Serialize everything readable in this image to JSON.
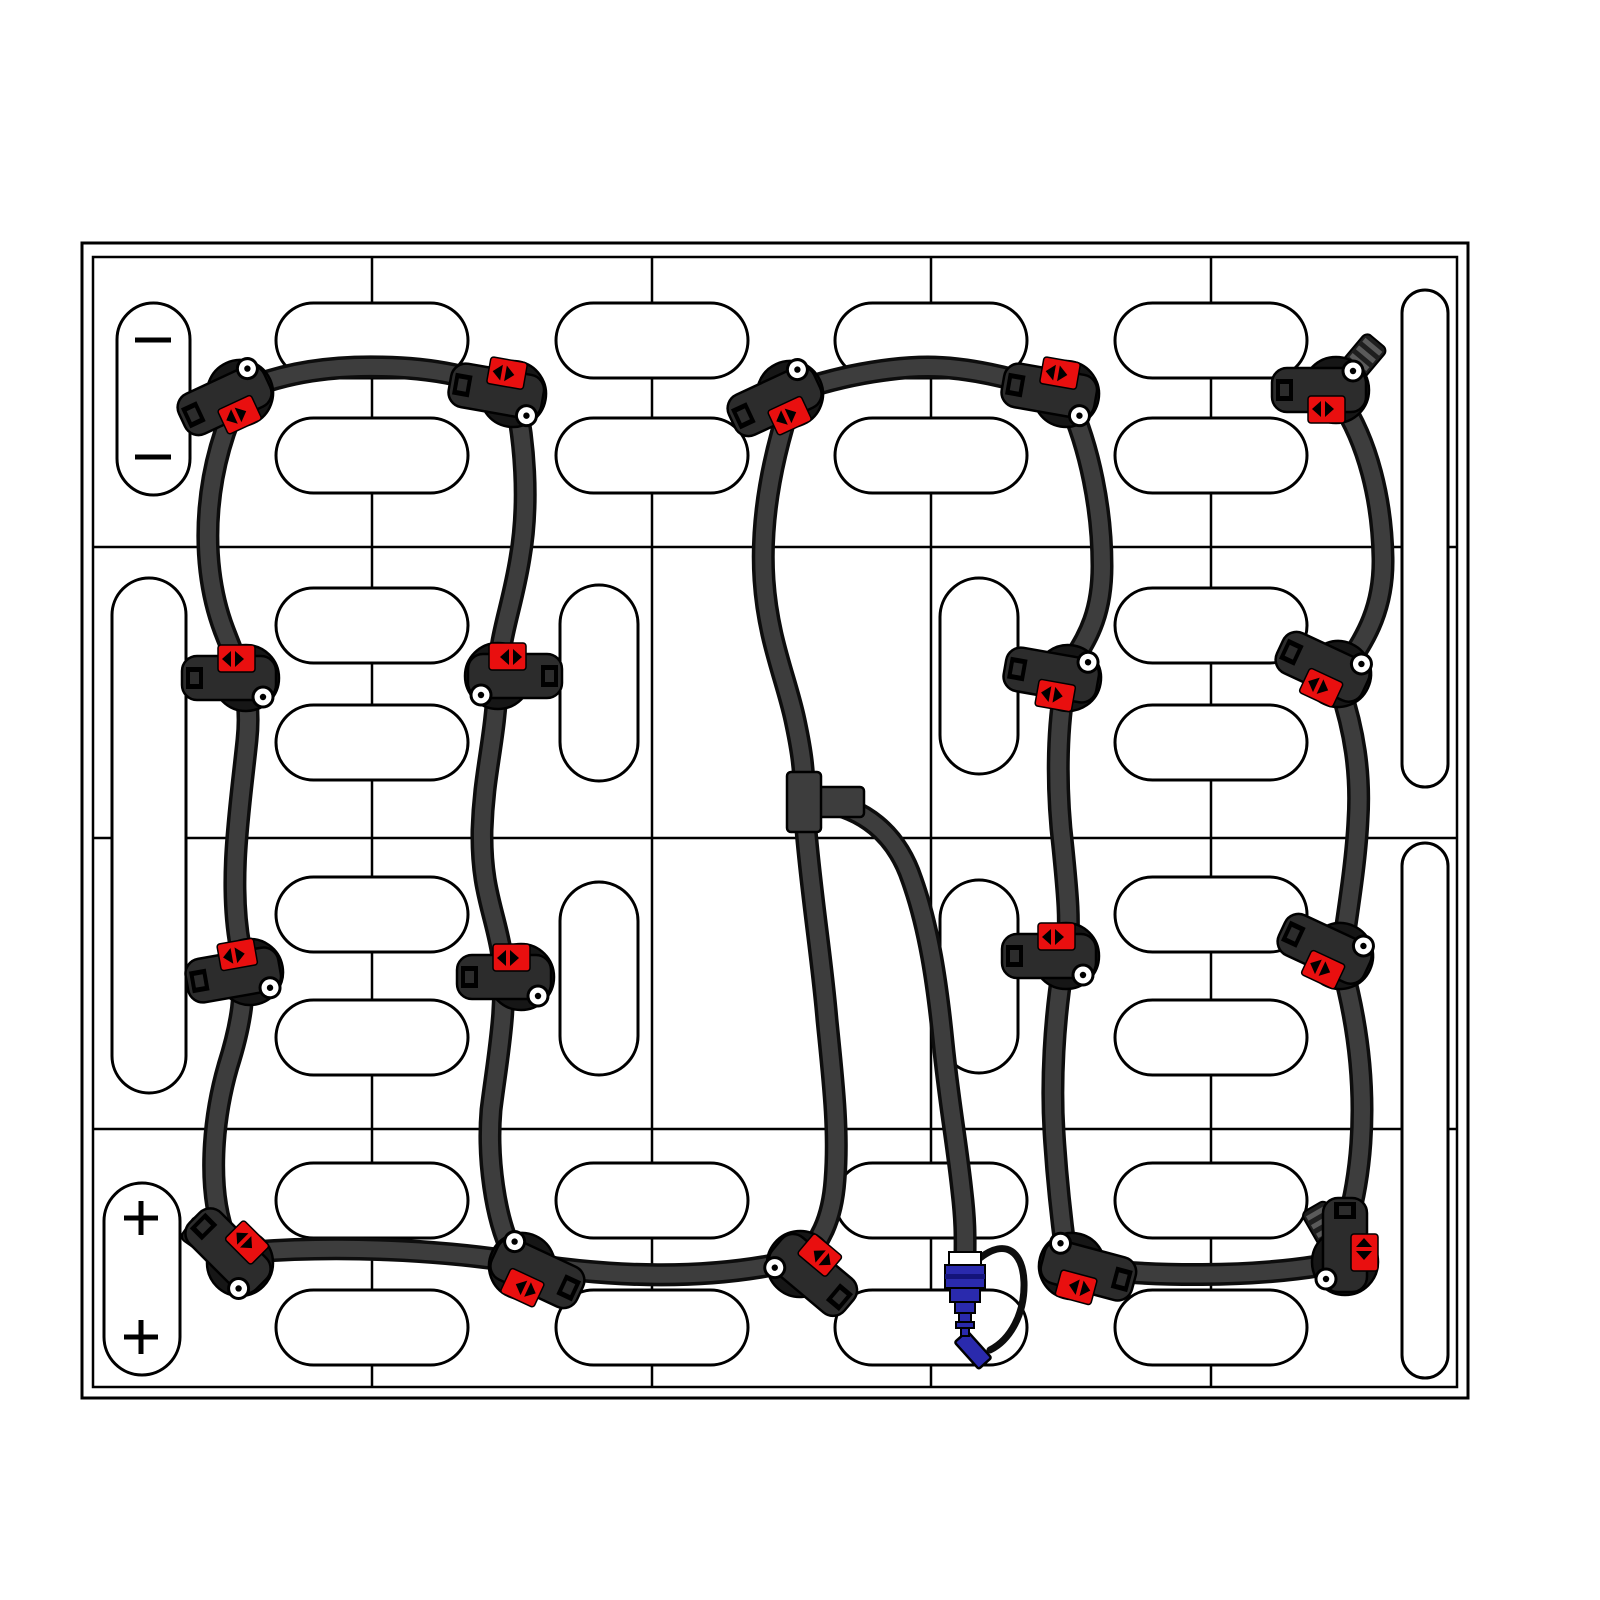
{
  "diagram": {
    "label": "battery-pack-watering-system-top-view",
    "canvas": {
      "width": 1600,
      "height": 1600,
      "background": "#ffffff"
    },
    "colors": {
      "outline": "#000000",
      "cell_fill": "#ffffff",
      "tube": "#3d3d3d",
      "tube_edge": "#0d0d0d",
      "valve_body": "#161616",
      "valve_jaw": "#2c2c2c",
      "indicator_red": "#e90f0f",
      "coupler_blue": "#2a2aad",
      "coupler_dark_blue": "#14147a",
      "cap_stripe": "#5a5a5a",
      "wire": "#0d0d0d",
      "white": "#ffffff"
    },
    "pack": {
      "outer_border": {
        "x": 82,
        "y": 243,
        "w": 1386,
        "h": 1155
      },
      "inner_border": {
        "x": 93,
        "y": 257,
        "w": 1364,
        "h": 1130
      },
      "column_lines_x": [
        372,
        652,
        931,
        1211
      ],
      "row_lines_y": [
        547,
        838,
        1129
      ]
    },
    "terminals": {
      "negative": {
        "pill": {
          "x": 117,
          "y": 303,
          "w": 73,
          "h": 192
        },
        "symbol": "minus",
        "marks": [
          {
            "x": 153,
            "y": 340
          },
          {
            "x": 153,
            "y": 457
          }
        ],
        "half_len": 18
      },
      "positive": {
        "pill": {
          "x": 104,
          "y": 1183,
          "w": 76,
          "h": 192
        },
        "symbol": "plus",
        "marks": [
          {
            "x": 141,
            "y": 1218
          },
          {
            "x": 141,
            "y": 1337
          }
        ],
        "half_len": 17
      }
    },
    "caps": {
      "horizontal_size": {
        "w": 192,
        "h": 75
      },
      "horizontal": [
        {
          "x": 276,
          "y": 303
        },
        {
          "x": 556,
          "y": 303
        },
        {
          "x": 835,
          "y": 303
        },
        {
          "x": 1115,
          "y": 303
        },
        {
          "x": 276,
          "y": 418
        },
        {
          "x": 556,
          "y": 418
        },
        {
          "x": 835,
          "y": 418
        },
        {
          "x": 1115,
          "y": 418
        },
        {
          "x": 276,
          "y": 588
        },
        {
          "x": 1115,
          "y": 588
        },
        {
          "x": 276,
          "y": 705
        },
        {
          "x": 1115,
          "y": 705
        },
        {
          "x": 276,
          "y": 877
        },
        {
          "x": 1115,
          "y": 877
        },
        {
          "x": 276,
          "y": 1000
        },
        {
          "x": 1115,
          "y": 1000
        },
        {
          "x": 276,
          "y": 1163
        },
        {
          "x": 556,
          "y": 1163
        },
        {
          "x": 835,
          "y": 1163
        },
        {
          "x": 1115,
          "y": 1163
        },
        {
          "x": 276,
          "y": 1290
        },
        {
          "x": 556,
          "y": 1290
        },
        {
          "x": 835,
          "y": 1290
        },
        {
          "x": 1115,
          "y": 1290
        }
      ],
      "vertical": [
        {
          "x": 560,
          "y": 585,
          "w": 78,
          "h": 196
        },
        {
          "x": 940,
          "y": 578,
          "w": 78,
          "h": 196
        },
        {
          "x": 560,
          "y": 882,
          "w": 78,
          "h": 193
        },
        {
          "x": 940,
          "y": 880,
          "w": 78,
          "h": 193
        },
        {
          "x": 112,
          "y": 578,
          "w": 74,
          "h": 515
        },
        {
          "x": 1402,
          "y": 290,
          "w": 46,
          "h": 497
        },
        {
          "x": 1402,
          "y": 843,
          "w": 46,
          "h": 535
        }
      ]
    },
    "tubing": {
      "width_outer": 23,
      "width_inner": 16,
      "segments": [
        {
          "name": "loop-a-left",
          "path": "M 242,392 C 206,460 196,556 224,630 C 240,672 252,692 247,740 C 240,808 228,880 240,946 C 248,990 240,1028 228,1066 C 213,1118 206,1190 226,1240 C 231,1250 235,1256 240,1261"
        },
        {
          "name": "loop-a-top",
          "path": "M 244,390 C 290,370 340,366 382,367 C 436,368 474,377 511,393"
        },
        {
          "name": "loop-a-right",
          "path": "M 515,396 C 524,440 530,500 520,558 C 512,608 500,632 498,676 C 495,744 484,770 482,830 C 481,888 494,910 501,950 C 509,1002 497,1060 491,1110 C 487,1158 495,1218 512,1252"
        },
        {
          "name": "loop-a-bottom",
          "path": "M 252,1252 C 340,1245 440,1250 516,1262 C 612,1278 706,1280 788,1262"
        },
        {
          "name": "stem-upper",
          "path": "M 792,398 C 772,458 760,520 764,580 C 768,640 786,678 795,720 C 801,748 804,768 804,790"
        },
        {
          "name": "stem-lower",
          "path": "M 806,830 C 812,900 822,960 827,1020 C 833,1080 839,1130 835,1180 C 832,1222 818,1244 804,1258"
        },
        {
          "name": "supply-branch",
          "path": "M 822,802 C 862,808 896,832 912,880 C 929,928 937,982 943,1042 C 949,1102 957,1144 962,1192 C 966,1226 965,1242 965,1260"
        },
        {
          "name": "loop-b-top",
          "path": "M 794,392 C 850,372 902,367 928,367 C 964,367 1014,377 1058,394"
        },
        {
          "name": "chain-4-upper",
          "path": "M 1068,400 C 1090,448 1102,510 1102,566 C 1102,622 1082,644 1070,666"
        },
        {
          "name": "chain-4-mid",
          "path": "M 1064,690 C 1056,740 1057,798 1063,848 C 1068,898 1070,922 1067,948"
        },
        {
          "name": "chain-4-lower",
          "path": "M 1063,966 C 1054,1022 1051,1082 1054,1132 C 1057,1182 1062,1224 1066,1254"
        },
        {
          "name": "bottom-link",
          "path": "M 1082,1268 C 1156,1277 1250,1277 1318,1266"
        },
        {
          "name": "chain-5-upper",
          "path": "M 1340,400 C 1368,442 1382,500 1383,558 C 1384,612 1362,642 1348,664"
        },
        {
          "name": "chain-5-mid",
          "path": "M 1340,688 C 1354,730 1361,772 1358,820 C 1356,862 1348,910 1343,946"
        },
        {
          "name": "chain-5-lower",
          "path": "M 1342,966 C 1354,1010 1362,1060 1362,1110 C 1362,1160 1354,1214 1337,1250"
        }
      ]
    },
    "tee": {
      "main": {
        "x": 787,
        "y": 772,
        "w": 34,
        "h": 60
      },
      "branch": {
        "x": 816,
        "y": 787,
        "w": 48,
        "h": 30
      }
    },
    "valves": [
      {
        "x": 240,
        "y": 393,
        "rot": -25,
        "flip": "none",
        "cap_angle": null
      },
      {
        "x": 513,
        "y": 394,
        "rot": 10,
        "flip": "y",
        "cap_angle": null
      },
      {
        "x": 790,
        "y": 394,
        "rot": -25,
        "flip": "none",
        "cap_angle": null
      },
      {
        "x": 1066,
        "y": 394,
        "rot": 10,
        "flip": "y",
        "cap_angle": null
      },
      {
        "x": 1336,
        "y": 390,
        "rot": 0,
        "flip": "none",
        "cap_angle": -50
      },
      {
        "x": 246,
        "y": 678,
        "rot": 0,
        "flip": "y",
        "cap_angle": null
      },
      {
        "x": 498,
        "y": 676,
        "rot": 180,
        "flip": "none",
        "cap_angle": null
      },
      {
        "x": 1068,
        "y": 678,
        "rot": 10,
        "flip": "none",
        "cap_angle": null
      },
      {
        "x": 1338,
        "y": 674,
        "rot": 25,
        "flip": "none",
        "cap_angle": null
      },
      {
        "x": 250,
        "y": 972,
        "rot": -10,
        "flip": "y",
        "cap_angle": null
      },
      {
        "x": 521,
        "y": 977,
        "rot": 0,
        "flip": "y",
        "cap_angle": null
      },
      {
        "x": 1066,
        "y": 956,
        "rot": 0,
        "flip": "y",
        "cap_angle": null
      },
      {
        "x": 1340,
        "y": 956,
        "rot": 25,
        "flip": "none",
        "cap_angle": null
      },
      {
        "x": 240,
        "y": 1263,
        "rot": 45,
        "flip": "y",
        "cap_angle": 215
      },
      {
        "x": 522,
        "y": 1266,
        "rot": 25,
        "flip": "x",
        "cap_angle": null
      },
      {
        "x": 800,
        "y": 1264,
        "rot": 220,
        "flip": "none",
        "cap_angle": null
      },
      {
        "x": 1072,
        "y": 1266,
        "rot": 15,
        "flip": "x",
        "cap_angle": null
      },
      {
        "x": 1345,
        "y": 1262,
        "rot": 90,
        "flip": "y",
        "cap_angle": -120
      }
    ],
    "supply_coupler": {
      "white_band": {
        "x": 949,
        "y": 1252,
        "w": 32,
        "h": 13
      },
      "body_blocks": [
        {
          "x": 945,
          "y": 1265,
          "w": 40,
          "h": 23
        },
        {
          "x": 950,
          "y": 1288,
          "w": 30,
          "h": 14
        },
        {
          "x": 955,
          "y": 1302,
          "w": 20,
          "h": 11
        },
        {
          "x": 959,
          "y": 1313,
          "w": 12,
          "h": 9
        },
        {
          "x": 956,
          "y": 1322,
          "w": 18,
          "h": 6
        },
        {
          "x": 961,
          "y": 1328,
          "w": 8,
          "h": 8
        }
      ],
      "divider": {
        "x": 945,
        "y": 1274,
        "w": 40,
        "h": 5
      },
      "wire_path": "M 980,1258 C 1006,1238 1023,1252 1024,1282 C 1025,1314 1010,1340 990,1350",
      "dust_cap": {
        "x": 973,
        "y": 1350,
        "w": 17,
        "h": 36,
        "rot": -42
      }
    }
  }
}
